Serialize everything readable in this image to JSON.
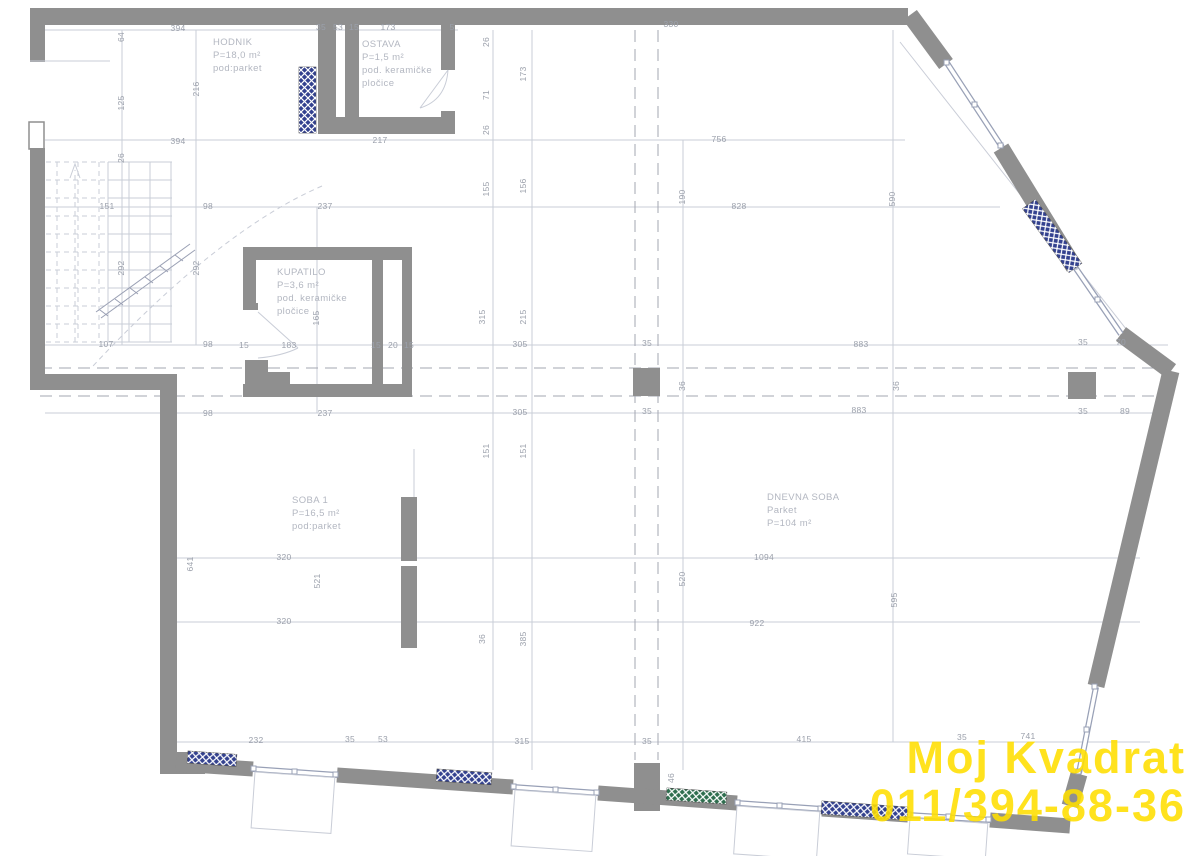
{
  "colors": {
    "wall": "#8f8f8f",
    "line": "#c9cdd7",
    "axis": "#a3a7b2",
    "window": "#98a0b6",
    "dim_text": "#9ba0ab",
    "room_text": "#b3b7c1",
    "hatch_blue": "#33418f",
    "hatch_green": "#2e6e4e",
    "watermark": "#ffdf00"
  },
  "watermark": {
    "line1": "Moj Kvadrat",
    "line2": "011/394-88-36"
  },
  "rooms": [
    {
      "id": "hodnik",
      "x": 213,
      "y": 36,
      "text": "HODNIK\nP=18,0 m²\npod:parket"
    },
    {
      "id": "ostava",
      "x": 362,
      "y": 38,
      "text": "OSTAVA\nP=1,5 m²\npod. keramičke\npločice"
    },
    {
      "id": "kupatilo",
      "x": 277,
      "y": 266,
      "text": "KUPATILO\nP=3,6 m²\npod. keramičke\npločice"
    },
    {
      "id": "soba-1",
      "x": 292,
      "y": 494,
      "text": "SOBA 1\nP=16,5 m²\npod:parket"
    },
    {
      "id": "dnevna-soba",
      "x": 767,
      "y": 491,
      "text": "DNEVNA SOBA\nParket\nP=104 m²"
    }
  ],
  "dimensions": [
    {
      "t": "394",
      "x": 178,
      "y": 28
    },
    {
      "t": "35",
      "x": 321,
      "y": 27
    },
    {
      "t": "53",
      "x": 338,
      "y": 27
    },
    {
      "t": "15",
      "x": 354,
      "y": 27
    },
    {
      "t": "173",
      "x": 388,
      "y": 27
    },
    {
      "t": "5",
      "x": 452,
      "y": 27
    },
    {
      "t": "330",
      "x": 671,
      "y": 24
    },
    {
      "t": "394",
      "x": 178,
      "y": 141
    },
    {
      "t": "217",
      "x": 380,
      "y": 140
    },
    {
      "t": "756",
      "x": 719,
      "y": 139
    },
    {
      "t": "151",
      "x": 107,
      "y": 206
    },
    {
      "t": "98",
      "x": 208,
      "y": 206
    },
    {
      "t": "237",
      "x": 325,
      "y": 206
    },
    {
      "t": "828",
      "x": 739,
      "y": 206
    },
    {
      "t": "107",
      "x": 106,
      "y": 344
    },
    {
      "t": "98",
      "x": 208,
      "y": 344
    },
    {
      "t": "15",
      "x": 244,
      "y": 345
    },
    {
      "t": "183",
      "x": 289,
      "y": 345
    },
    {
      "t": "15",
      "x": 376,
      "y": 345
    },
    {
      "t": "20",
      "x": 393,
      "y": 345
    },
    {
      "t": "15",
      "x": 409,
      "y": 345
    },
    {
      "t": "305",
      "x": 520,
      "y": 344
    },
    {
      "t": "35",
      "x": 647,
      "y": 343
    },
    {
      "t": "883",
      "x": 861,
      "y": 344
    },
    {
      "t": "35",
      "x": 1083,
      "y": 342
    },
    {
      "t": "70",
      "x": 1121,
      "y": 342
    },
    {
      "t": "98",
      "x": 208,
      "y": 413
    },
    {
      "t": "237",
      "x": 325,
      "y": 413
    },
    {
      "t": "305",
      "x": 520,
      "y": 412
    },
    {
      "t": "35",
      "x": 647,
      "y": 411
    },
    {
      "t": "883",
      "x": 859,
      "y": 410
    },
    {
      "t": "35",
      "x": 1083,
      "y": 411
    },
    {
      "t": "89",
      "x": 1125,
      "y": 411
    },
    {
      "t": "320",
      "x": 284,
      "y": 557
    },
    {
      "t": "1094",
      "x": 764,
      "y": 557
    },
    {
      "t": "320",
      "x": 284,
      "y": 621
    },
    {
      "t": "922",
      "x": 757,
      "y": 623
    },
    {
      "t": "232",
      "x": 256,
      "y": 740
    },
    {
      "t": "35",
      "x": 350,
      "y": 739
    },
    {
      "t": "53",
      "x": 383,
      "y": 739
    },
    {
      "t": "315",
      "x": 522,
      "y": 741
    },
    {
      "t": "35",
      "x": 647,
      "y": 741
    },
    {
      "t": "415",
      "x": 804,
      "y": 739
    },
    {
      "t": "35",
      "x": 962,
      "y": 737
    },
    {
      "t": "741",
      "x": 1028,
      "y": 736
    },
    {
      "t": "64",
      "x": 121,
      "y": 37,
      "o": "v"
    },
    {
      "t": "125",
      "x": 121,
      "y": 103,
      "o": "v"
    },
    {
      "t": "216",
      "x": 196,
      "y": 89,
      "o": "v"
    },
    {
      "t": "26",
      "x": 121,
      "y": 158,
      "o": "v"
    },
    {
      "t": "292",
      "x": 121,
      "y": 268,
      "o": "v"
    },
    {
      "t": "292",
      "x": 196,
      "y": 268,
      "o": "v"
    },
    {
      "t": "26",
      "x": 486,
      "y": 42,
      "o": "v"
    },
    {
      "t": "71",
      "x": 486,
      "y": 95,
      "o": "v"
    },
    {
      "t": "26",
      "x": 486,
      "y": 130,
      "o": "v"
    },
    {
      "t": "173",
      "x": 523,
      "y": 74,
      "o": "v"
    },
    {
      "t": "155",
      "x": 486,
      "y": 189,
      "o": "v"
    },
    {
      "t": "156",
      "x": 523,
      "y": 186,
      "o": "v"
    },
    {
      "t": "190",
      "x": 682,
      "y": 197,
      "o": "v"
    },
    {
      "t": "590",
      "x": 892,
      "y": 199,
      "o": "v"
    },
    {
      "t": "165",
      "x": 316,
      "y": 318,
      "o": "v"
    },
    {
      "t": "315",
      "x": 482,
      "y": 317,
      "o": "v"
    },
    {
      "t": "215",
      "x": 523,
      "y": 317,
      "o": "v"
    },
    {
      "t": "36",
      "x": 682,
      "y": 386,
      "o": "v"
    },
    {
      "t": "36",
      "x": 896,
      "y": 386,
      "o": "v"
    },
    {
      "t": "151",
      "x": 486,
      "y": 451,
      "o": "v"
    },
    {
      "t": "151",
      "x": 523,
      "y": 451,
      "o": "v"
    },
    {
      "t": "641",
      "x": 190,
      "y": 564,
      "o": "v"
    },
    {
      "t": "521",
      "x": 317,
      "y": 581,
      "o": "v"
    },
    {
      "t": "520",
      "x": 682,
      "y": 579,
      "o": "v"
    },
    {
      "t": "595",
      "x": 894,
      "y": 600,
      "o": "v"
    },
    {
      "t": "36",
      "x": 482,
      "y": 639,
      "o": "v"
    },
    {
      "t": "385",
      "x": 523,
      "y": 639,
      "o": "v"
    },
    {
      "t": "46",
      "x": 671,
      "y": 778,
      "o": "v"
    }
  ]
}
